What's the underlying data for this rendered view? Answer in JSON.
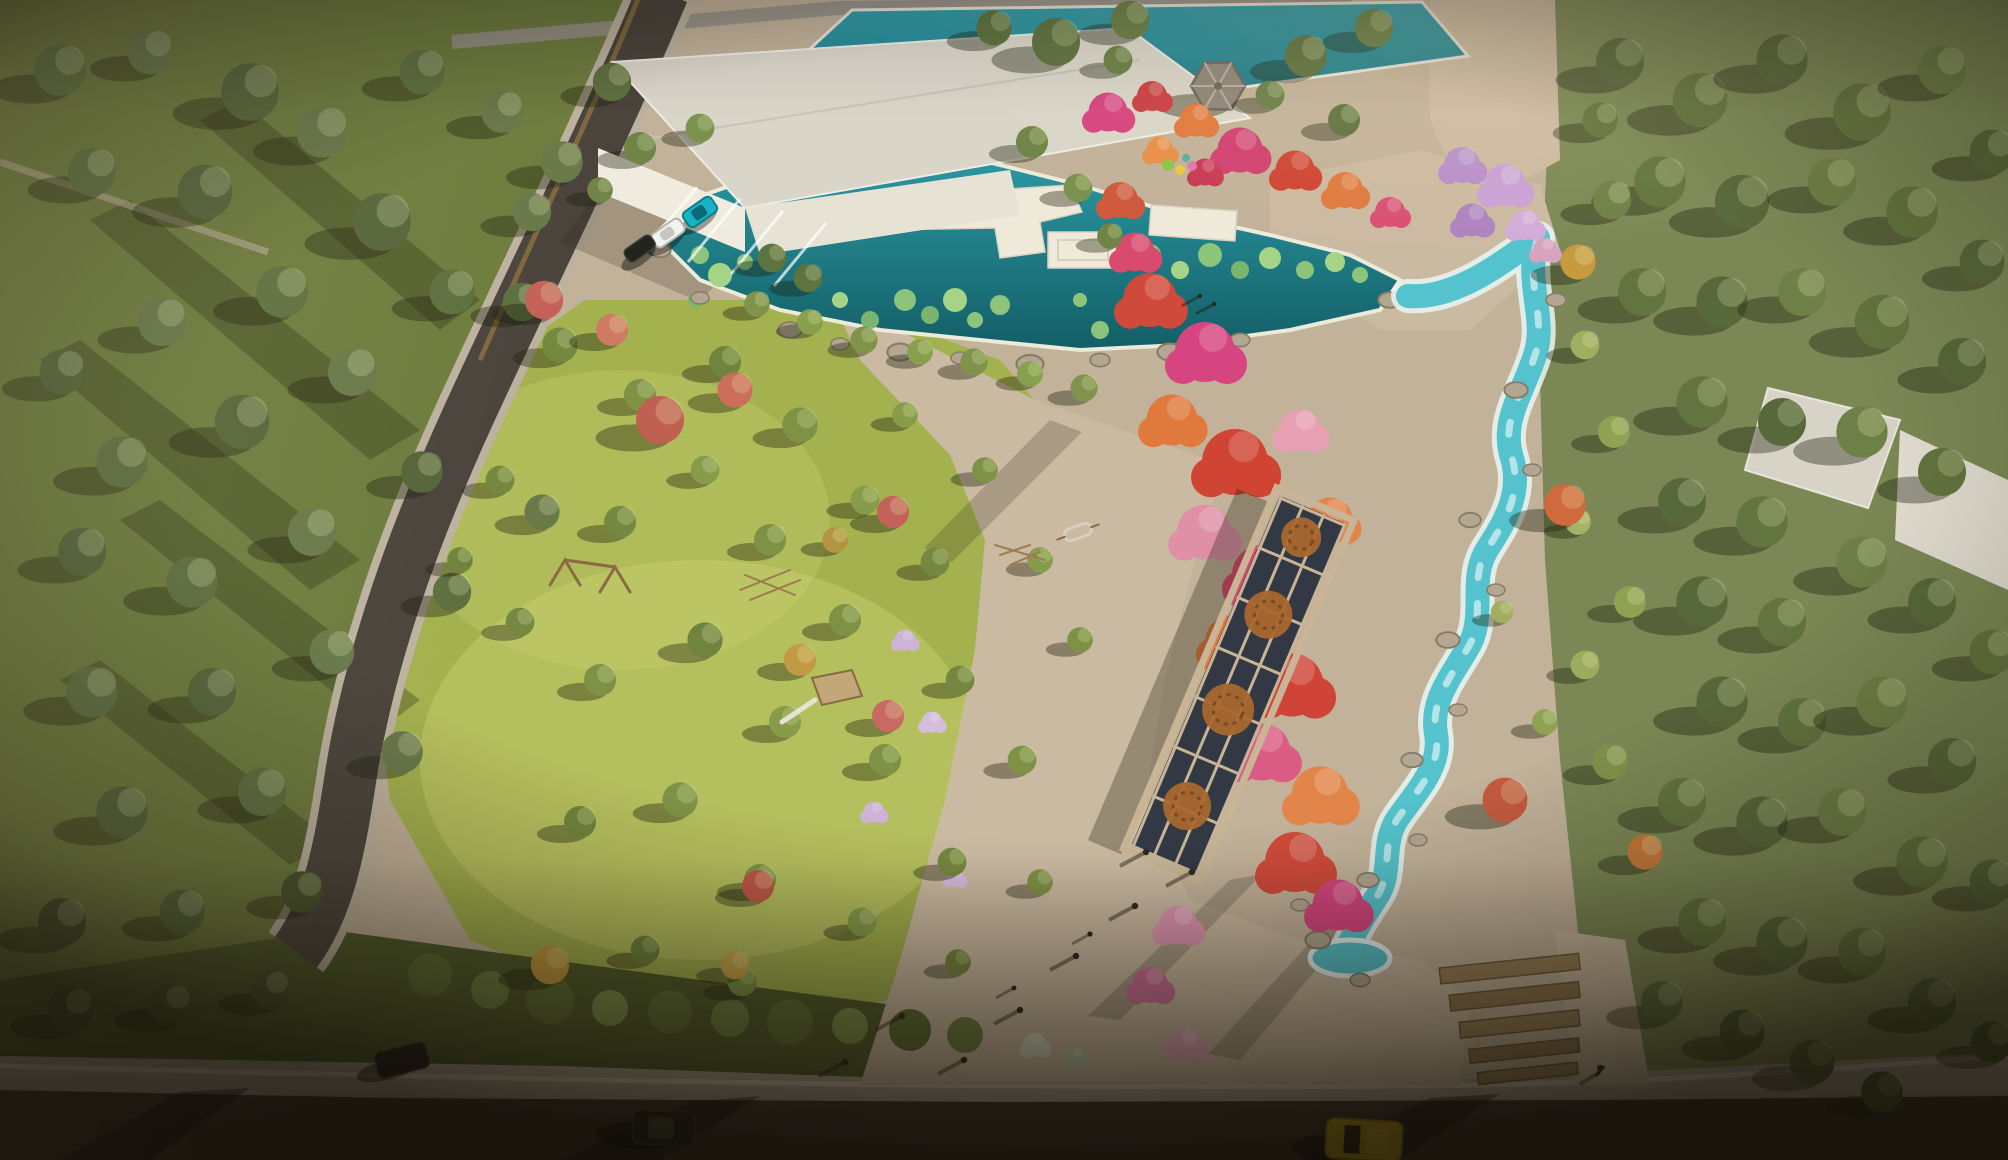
{
  "image": {
    "kind": "aerial-architectural-render",
    "subject": "bird's-eye rendering of a park masterplan: lotus pond with boardwalk, hexagonal pavilion, red flower stream corridor, pergola trellis walkway, playground lawn, perimeter roads with cars"
  },
  "palette": {
    "plaza": "#c2b29a",
    "plaza2": "#cbbaa2",
    "meadow": "#6e7c3e",
    "lawn": "#a3b14e",
    "lawn-light": "#c9d172",
    "forest-base": "#7b8855",
    "verge": "#4f5c2c",
    "pond-1": "#2b98a2",
    "pond-2": "#135e66",
    "pool-1": "#35a0ac",
    "pool-2": "#1d7884",
    "stream": "#54c3cd",
    "foam": "#e9f6f3",
    "green-pond": "#3f8b52",
    "roof": "#d9d5c9",
    "wall": "#efecdf",
    "road": "#3f3a33",
    "sidewalk": "#b2a897",
    "curb-wall": "#8a6f3e",
    "pergola-frame": "#c9b596",
    "pergola-panel": "#323945",
    "medallion": "#a9672f",
    "flower-magenta": "#d6457f",
    "flower-red": "#cf4433",
    "flower-orange": "#e0793c",
    "flower-pink": "#e392a8",
    "lilac": "#bd93cd",
    "car-teal": "#17b3c4",
    "car-white": "#f2f2ee",
    "car-dark": "#23241f",
    "taxi": "#d8b41f"
  },
  "objects": {
    "water_features": [
      "upper-pool",
      "lotus-pond-with-lilypads",
      "green-pond",
      "winding-stream-with-rapids"
    ],
    "structures": [
      "white-gallery-building",
      "hexagonal-pavilion",
      "pergola-trellis-with-medallions",
      "timber-terrace-steps",
      "playground-equipment",
      "white-houses-right"
    ],
    "vehicles": {
      "parking_lot": [
        "teal",
        "white",
        "dark"
      ],
      "street": [
        "dark-sedan-bottom",
        "dark-car-left",
        "yellow-taxi-right"
      ]
    },
    "people_on_plaza": 8,
    "dogs": 2,
    "cyclist": 1
  }
}
